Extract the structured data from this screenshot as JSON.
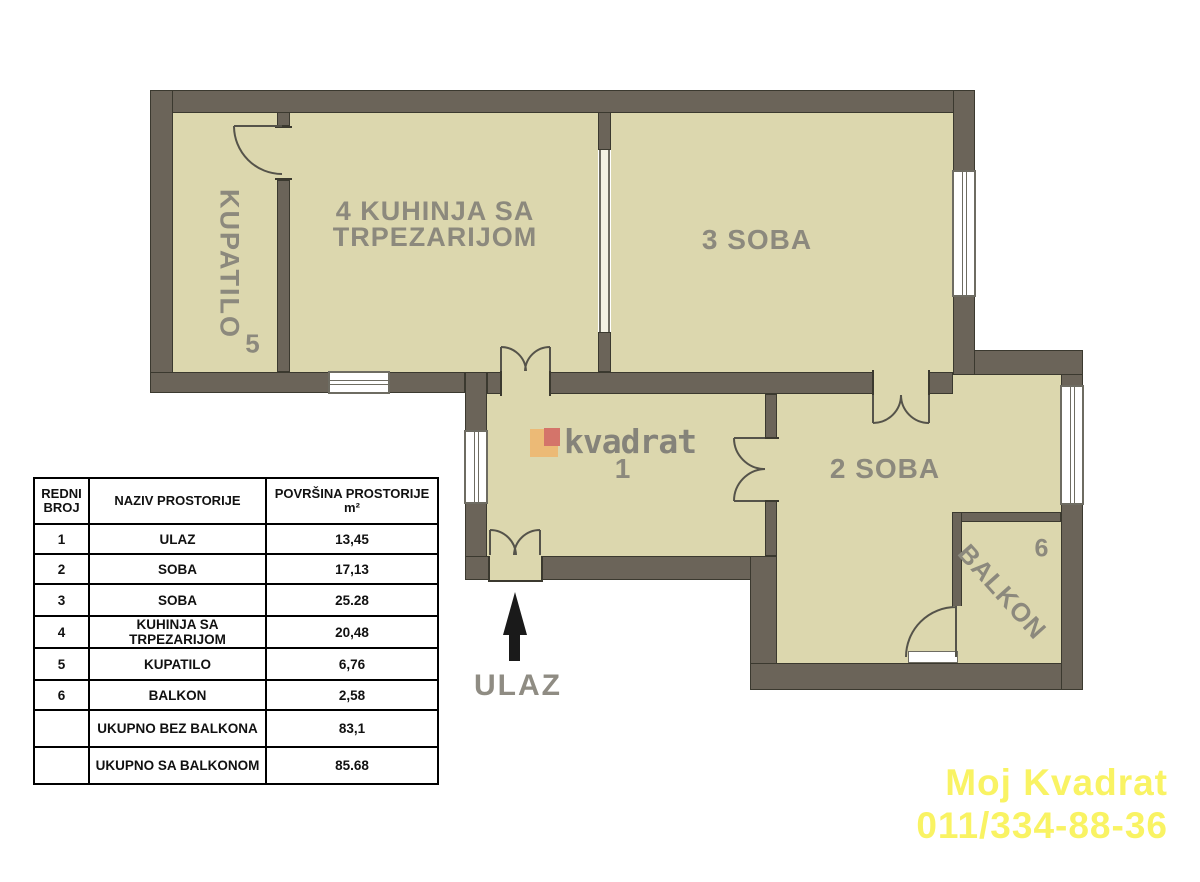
{
  "floor_plan": {
    "labels": {
      "bathroom": "KUPATILO",
      "bathroom_number": "5",
      "kitchen_line1": "4  KUHINJA SA",
      "kitchen_line2": "TRPEZARIJOM",
      "room3": "3 SOBA",
      "room2": "2 SOBA",
      "hall_number": "1",
      "balcony": "BALKON",
      "balcony_number": "6",
      "entrance": "ULAZ"
    },
    "watermark": {
      "text": "kvadrat"
    },
    "colors": {
      "wall": "#6b6459",
      "wall_outline": "#3b392f",
      "floor": "#dcd7ae",
      "label_gray": "#8c897d",
      "logo_orange": "#ecba76",
      "logo_red": "#d4746a",
      "contact_yellow": "#f9f363",
      "arrow_black": "#1a1a1a"
    }
  },
  "table": {
    "headers": {
      "col1": "REDNI BROJ",
      "col2": "NAZIV PROSTORIJE",
      "col3": "POVRŠINA PROSTORIJE m²"
    },
    "rows": [
      {
        "num": "1",
        "name": "ULAZ",
        "area": "13,45"
      },
      {
        "num": "2",
        "name": "SOBA",
        "area": "17,13"
      },
      {
        "num": "3",
        "name": "SOBA",
        "area": "25.28"
      },
      {
        "num": "4",
        "name": "KUHINJA SA TRPEZARIJOM",
        "area": "20,48"
      },
      {
        "num": "5",
        "name": "KUPATILO",
        "area": "6,76"
      },
      {
        "num": "6",
        "name": "BALKON",
        "area": "2,58"
      },
      {
        "num": "",
        "name": "UKUPNO BEZ BALKONA",
        "area": "83,1"
      },
      {
        "num": "",
        "name": "UKUPNO SA BALKONOM",
        "area": "85.68"
      }
    ]
  },
  "contact": {
    "line1": "Moj Kvadrat",
    "line2": "011/334-88-36"
  }
}
